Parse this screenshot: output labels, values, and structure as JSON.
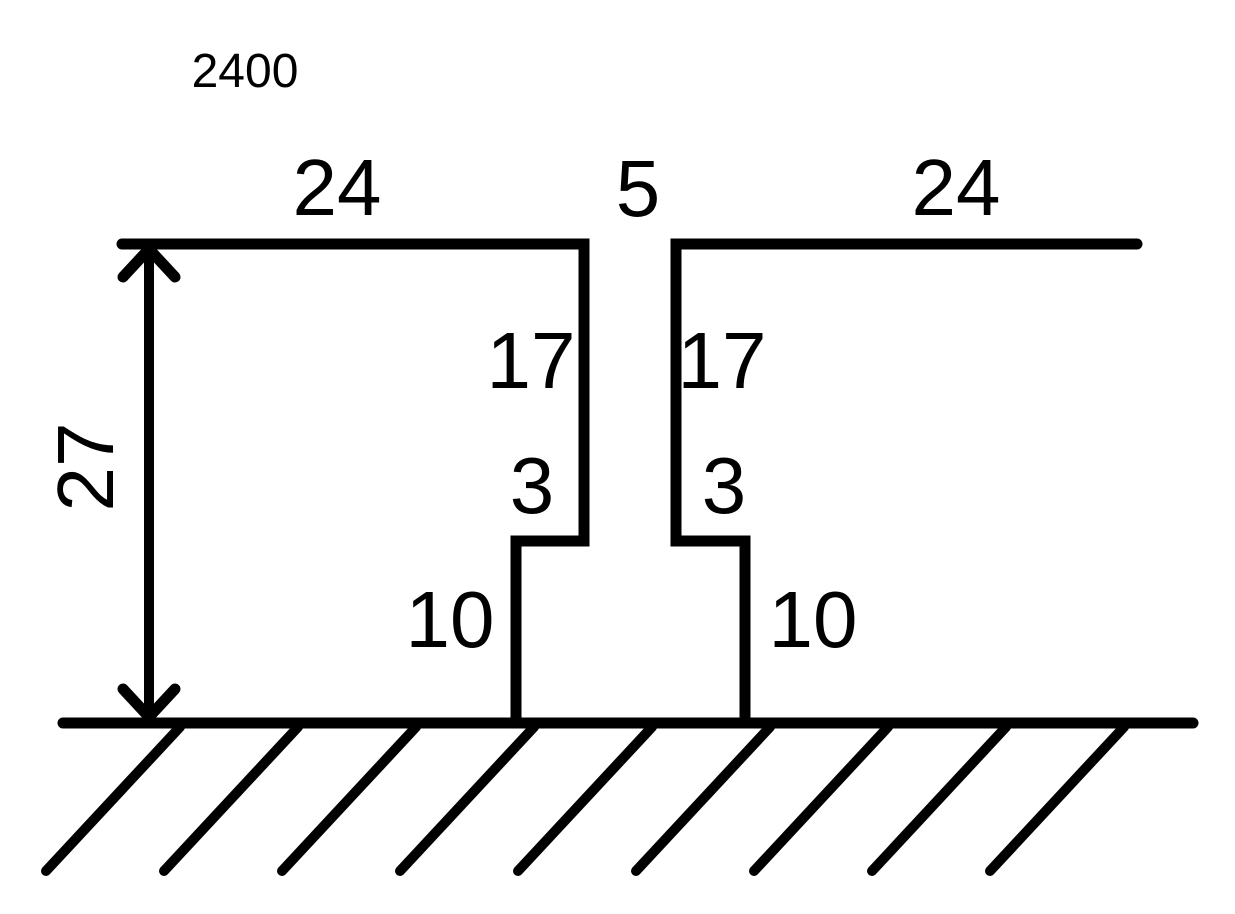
{
  "diagram": {
    "note_top_left": "2400",
    "dimensions": {
      "left_top_width": "24",
      "gap_width": "5",
      "right_top_width": "24",
      "left_inner_depth": "17",
      "right_inner_depth": "17",
      "left_step_width": "3",
      "right_step_width": "3",
      "left_base_height": "10",
      "right_base_height": "10",
      "total_height": "27"
    },
    "line_color": "#000000",
    "background_color": "#ffffff"
  }
}
